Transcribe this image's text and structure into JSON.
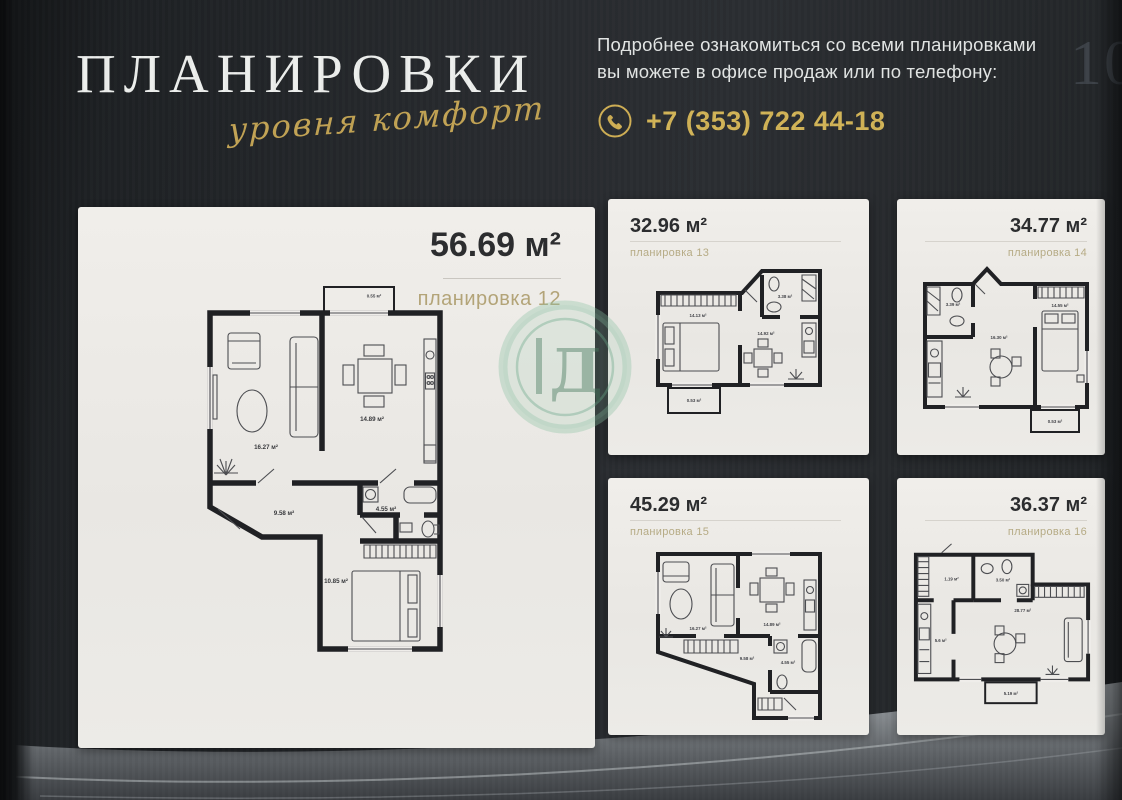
{
  "page": {
    "number": "10"
  },
  "header": {
    "title": "ПЛАНИРОВКИ",
    "tagline": "уровня комфорт",
    "info_line1": "Подробнее ознакомиться со всеми планировками",
    "info_line2": "вы можете в офисе продаж или по телефону:",
    "phone": "+7 (353) 722 44-18"
  },
  "watermark": {
    "letter": "Д"
  },
  "colors": {
    "accent_gold": "#d2b457",
    "page_bg": "#26292d",
    "card_bg": "#ecebe7",
    "plan_name_tan": "#b3a478",
    "watermark_green": "#6faa8b"
  },
  "plans": {
    "main": {
      "area": "56.69 м²",
      "name": "планировка 12",
      "rooms": {
        "living": "16.27 м²",
        "kitchen": "14.89 м²",
        "hall": "9.58 м²",
        "bath": "4.55 м²",
        "bedroom": "10.85 м²",
        "balcony": "0.55 м²"
      }
    },
    "small": [
      {
        "area": "32.96 м²",
        "name": "планировка 13",
        "rooms": {
          "bedroom": "14.13 м²",
          "living": "14.92 м²",
          "bath": "3.38 м²",
          "balcony": "0.53 м²"
        }
      },
      {
        "area": "34.77 м²",
        "name": "планировка 14",
        "rooms": {
          "bath": "3.39 м²",
          "living": "16.30 м²",
          "bedroom": "14.55 м²",
          "balcony": "0.53 м²"
        }
      },
      {
        "area": "45.29 м²",
        "name": "планировка 15",
        "rooms": {
          "living": "16.27 м²",
          "kitchen": "14.89 м²",
          "hall": "9.58 м²",
          "bath": "4.55 м²"
        }
      },
      {
        "area": "36.37 м²",
        "name": "планировка 16",
        "rooms": {
          "hall": "1.19 м²",
          "bath": "3.50 м²",
          "living": "28.77 м²",
          "kitchen": "5.6 м²",
          "balcony": "5.19 м²"
        }
      }
    ]
  }
}
